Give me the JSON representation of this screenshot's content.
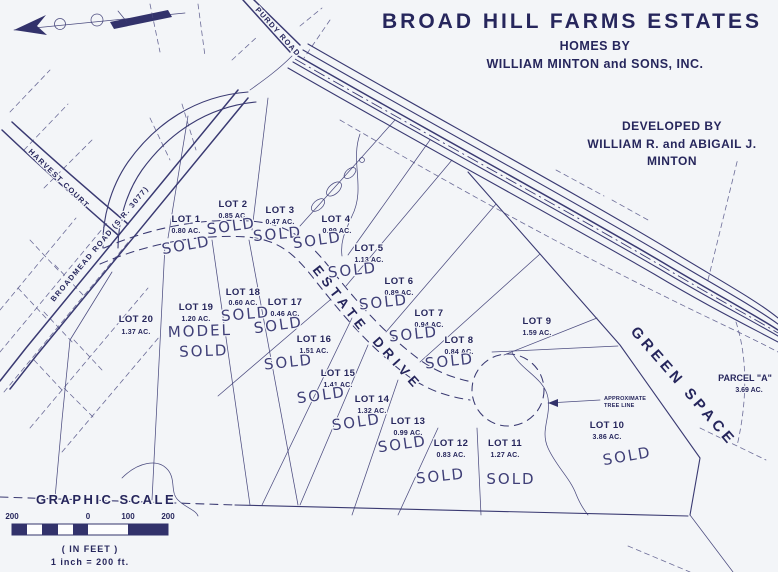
{
  "colors": {
    "ink": "#3a3a72",
    "text_ink": "#26265c",
    "paper": "#f3f5f8"
  },
  "title_block": {
    "title": "BROAD HILL FARMS ESTATES",
    "homes_by": "HOMES BY",
    "homes_by_name": "WILLIAM MINTON and SONS, INC."
  },
  "developer_block": {
    "line1": "DEVELOPED BY",
    "line2": "WILLIAM R. and ABIGAIL J.",
    "line3": "MINTON"
  },
  "roads": {
    "purdy": "PURDY ROAD",
    "harvest": "HARVEST COURT",
    "broadmead": "BROADMEAD ROAD (S.R. 3077)",
    "estate_line1": "ESTATE",
    "estate_line2": "DRIVE"
  },
  "areas": {
    "green_space": "GREEN SPACE",
    "parcel_a": "PARCEL \"A\"",
    "parcel_a_acreage": "3.69 AC.",
    "tree_note_line1": "APPROXIMATE",
    "tree_note_line2": "TREE LINE"
  },
  "lots": [
    {
      "name": "LOT 1",
      "acreage": "0.80 AC.",
      "status": "SOLD"
    },
    {
      "name": "LOT 2",
      "acreage": "0.85 AC.",
      "status": "SOLD"
    },
    {
      "name": "LOT 3",
      "acreage": "0.47 AC.",
      "status": "SOLD"
    },
    {
      "name": "LOT 4",
      "acreage": "0.99 AC.",
      "status": "SOLD"
    },
    {
      "name": "LOT 5",
      "acreage": "1.13 AC.",
      "status": "SOLD"
    },
    {
      "name": "LOT 6",
      "acreage": "0.89 AC.",
      "status": "SOLD"
    },
    {
      "name": "LOT 7",
      "acreage": "0.94 AC.",
      "status": "SOLD"
    },
    {
      "name": "LOT 8",
      "acreage": "0.84 AC.",
      "status": "SOLD"
    },
    {
      "name": "LOT 9",
      "acreage": "1.59 AC.",
      "status": ""
    },
    {
      "name": "LOT 10",
      "acreage": "3.86 AC.",
      "status": "SOLD"
    },
    {
      "name": "LOT 11",
      "acreage": "1.27 AC.",
      "status": "SOLD"
    },
    {
      "name": "LOT 12",
      "acreage": "0.83 AC.",
      "status": "SOLD"
    },
    {
      "name": "LOT 13",
      "acreage": "0.99 AC.",
      "status": "SOLD"
    },
    {
      "name": "LOT 14",
      "acreage": "1.32 AC.",
      "status": "SOLD"
    },
    {
      "name": "LOT 15",
      "acreage": "1.41 AC.",
      "status": "SOLD"
    },
    {
      "name": "LOT 16",
      "acreage": "1.51 AC.",
      "status": "SOLD"
    },
    {
      "name": "LOT 17",
      "acreage": "0.46 AC.",
      "status": "SOLD"
    },
    {
      "name": "LOT 18",
      "acreage": "0.60 AC.",
      "status": "SOLD"
    },
    {
      "name": "LOT 19",
      "acreage": "1.20 AC.",
      "status": "SOLD",
      "note": "MODEL"
    },
    {
      "name": "LOT 20",
      "acreage": "1.37 AC.",
      "status": ""
    }
  ],
  "scale": {
    "heading": "GRAPHIC SCALE",
    "ticks": [
      "200",
      "0",
      "100",
      "200"
    ],
    "units": "( IN FEET )",
    "ratio": "1 inch = 200 ft."
  }
}
